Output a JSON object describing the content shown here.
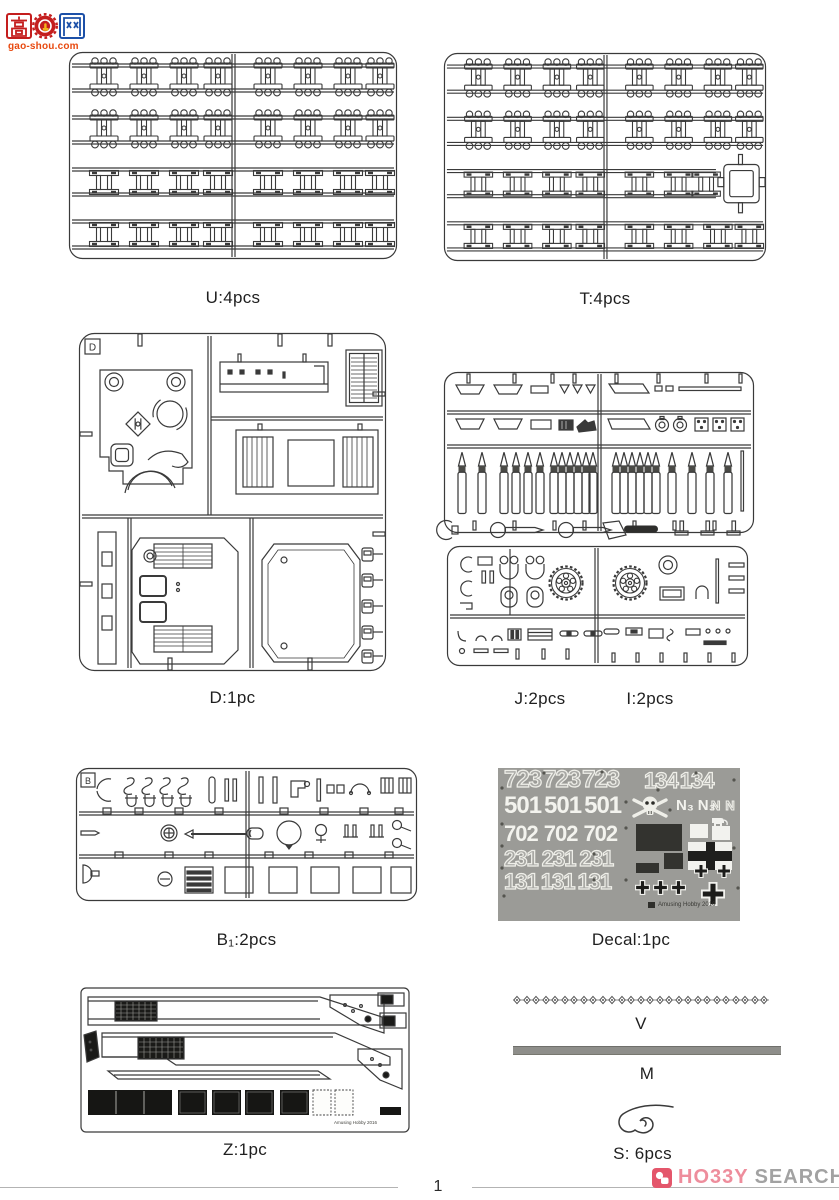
{
  "watermark": {
    "char_left": "高",
    "char_right": "网",
    "url": "gao-shou.com"
  },
  "parts": {
    "u": {
      "label": "U:4pcs"
    },
    "t": {
      "label": "T:4pcs"
    },
    "d": {
      "label": "D:1pc",
      "letter": "D"
    },
    "j": {
      "label": "J:2pcs"
    },
    "i": {
      "label": "I:2pcs"
    },
    "b1": {
      "label": "B₁:2pcs",
      "letter": "B"
    },
    "decal": {
      "label": "Decal:1pc"
    },
    "z": {
      "label": "Z:1pc"
    },
    "v": {
      "label": "V"
    },
    "m": {
      "label": "M"
    },
    "s": {
      "label": "S: 6pcs"
    }
  },
  "decal_sheet": {
    "n723": "723",
    "n134": "134",
    "n501": "501",
    "n702": "702",
    "n231": "231",
    "n131": "131",
    "n_sub": "N₃",
    "n_plain": "N",
    "fine_print": "Amusing Hobby 2016",
    "icons": [
      "skull-crossbones",
      "elephant",
      "balkenkreuz-cross",
      "number-plate"
    ]
  },
  "z_fret": {
    "fine_print": "Amusing Hobby 2016"
  },
  "footer": {
    "page_number": "1"
  },
  "brand": {
    "name_pink": "HO33Y",
    "name_gray": "SEARCH"
  }
}
